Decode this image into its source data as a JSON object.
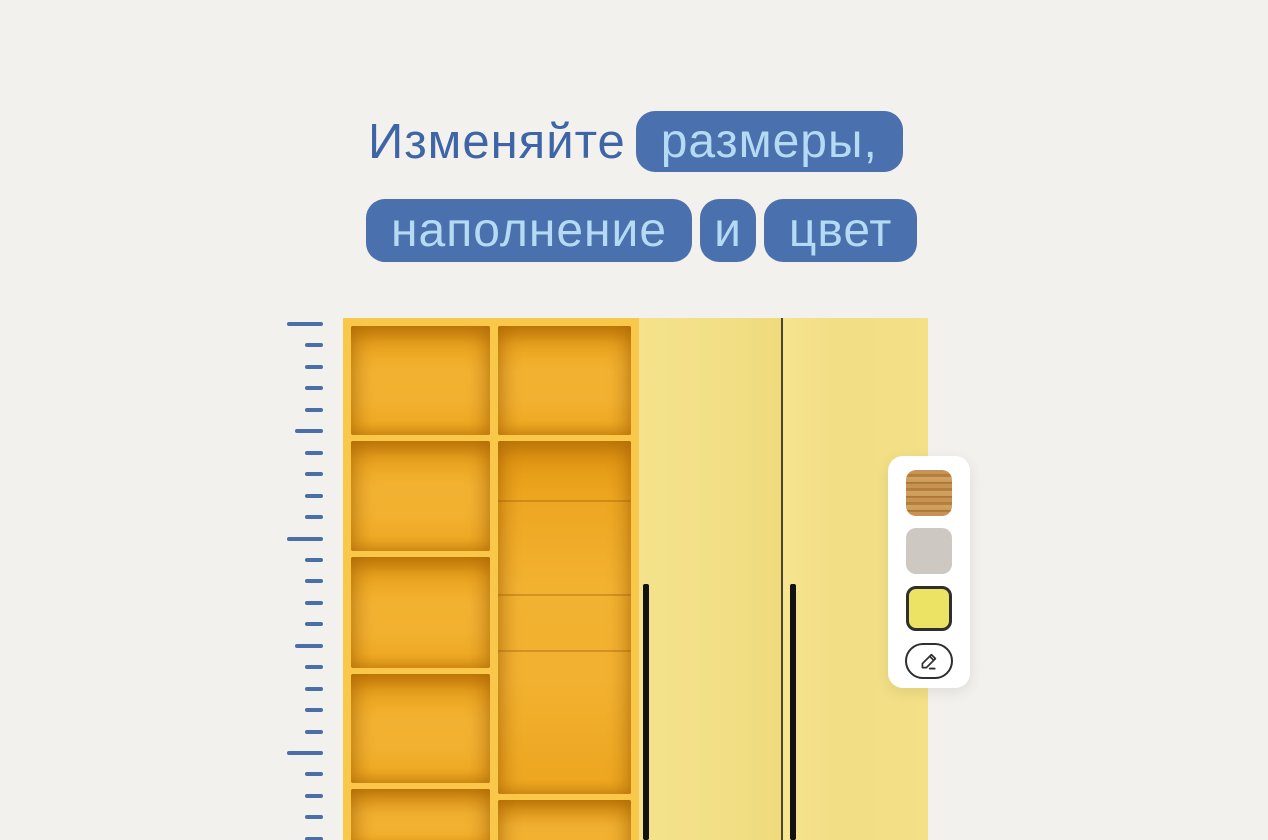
{
  "title": {
    "line1_text": "Изменяйте",
    "line1_badge": "размеры,",
    "line2_badges": [
      "наполнение",
      "и",
      "цвет"
    ]
  },
  "colors": {
    "background": "#f2f1ee",
    "title_text": "#3e66a7",
    "badge_bg": "#4a70ad",
    "badge_text": "#b5daf3",
    "ruler": "#4a6fa8",
    "shelf_frame": "#f9c84b",
    "shelf_interior": "#f0ad27",
    "door": "#f3e087",
    "handle": "#121212",
    "panel_bg": "#ffffff"
  },
  "ruler": {
    "tick_count": 25,
    "major_every": 10,
    "medium_every": 5
  },
  "wardrobe": {
    "open_columns": 2,
    "column1_shelf_cells": 5,
    "door_count": 2,
    "handle_count": 2
  },
  "color_panel": {
    "swatches": [
      {
        "name": "wood-swatch",
        "type": "wood",
        "label": "wood texture",
        "selected": false
      },
      {
        "name": "gray-swatch",
        "type": "color",
        "color": "#cdc8c1",
        "selected": false
      },
      {
        "name": "yellow-swatch",
        "type": "color",
        "color": "#ece264",
        "selected": true
      }
    ],
    "edit_icon": "pencil-icon"
  }
}
